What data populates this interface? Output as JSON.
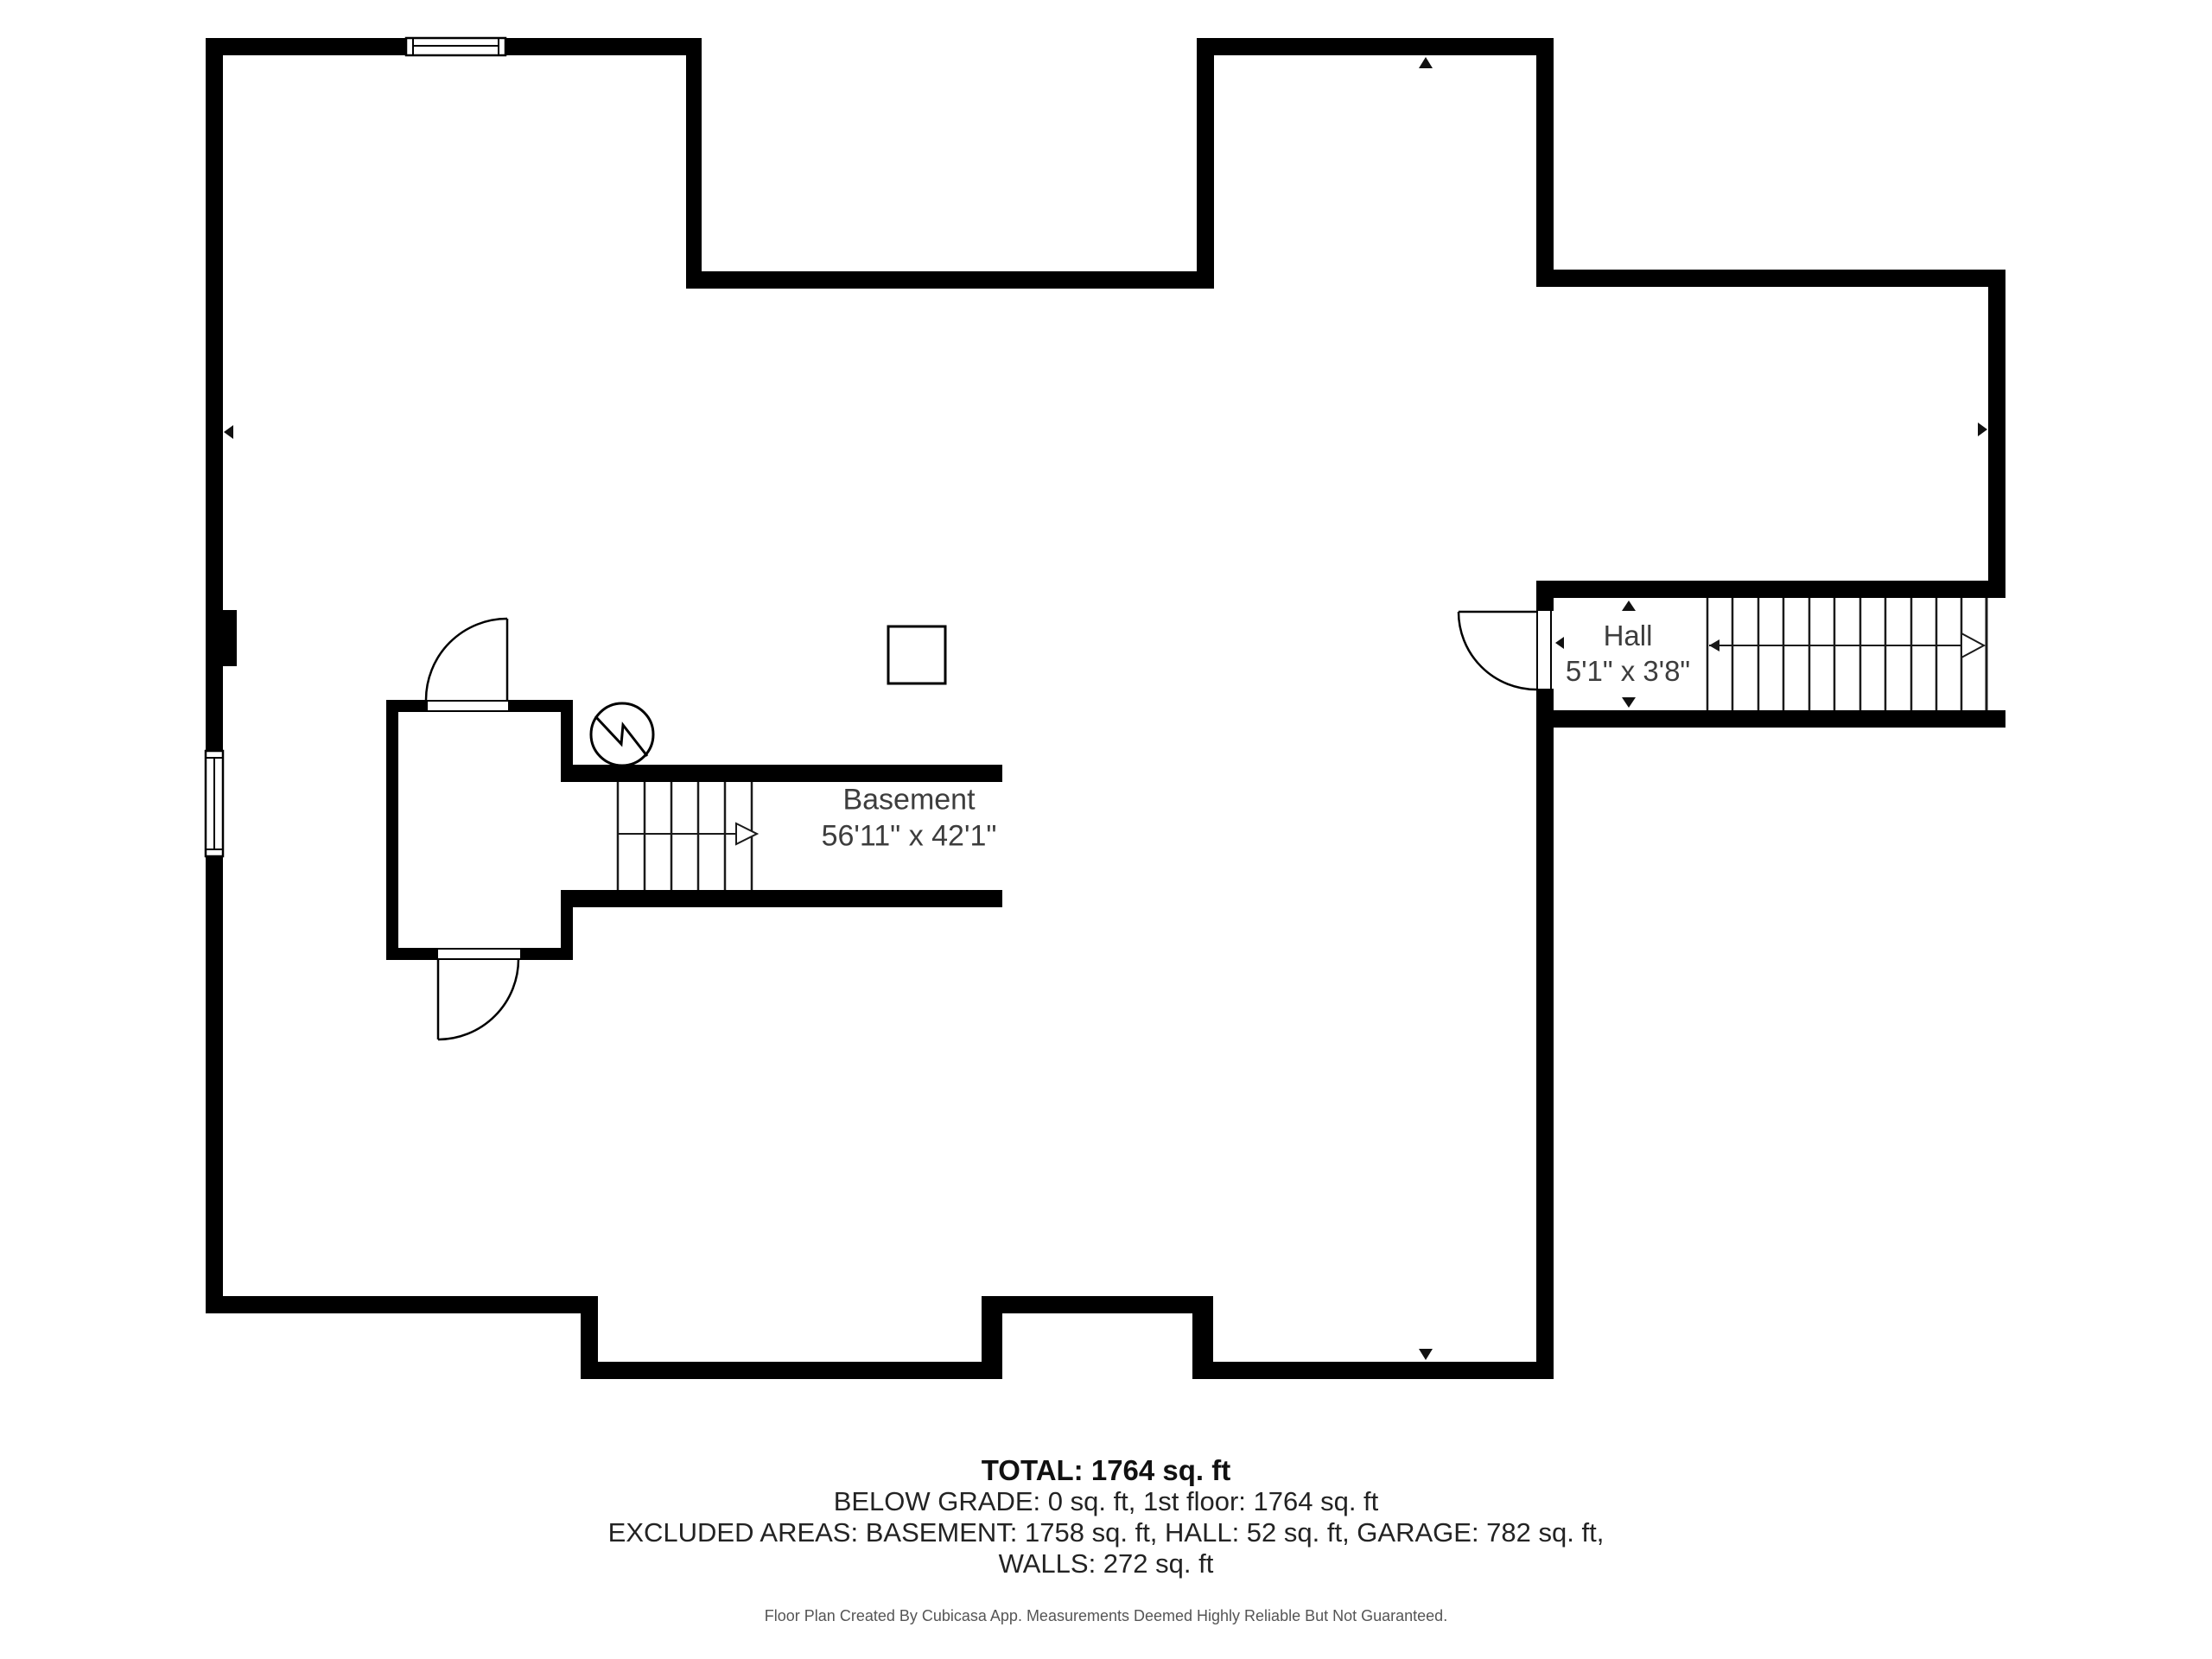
{
  "rooms": {
    "basement": {
      "name": "Basement",
      "dimensions": "56'11\" x 42'1\""
    },
    "hall": {
      "name": "Hall",
      "dimensions": "5'1\" x 3'8\""
    }
  },
  "summary": {
    "total": "TOTAL: 1764 sq. ft",
    "below_grade": "BELOW GRADE: 0 sq. ft, 1st floor: 1764 sq. ft",
    "excluded_areas": "EXCLUDED AREAS: BASEMENT: 1758 sq. ft, HALL: 52 sq. ft, GARAGE: 782 sq. ft,",
    "walls": "WALLS: 272 sq. ft"
  },
  "footer": {
    "disclaimer": "Floor Plan Created By Cubicasa App. Measurements Deemed Highly Reliable But Not Guaranteed."
  },
  "colors": {
    "wall": "#000000",
    "background": "#ffffff",
    "room_label": "#3d3d3d",
    "summary_text": "#232323",
    "footer_text": "#555555"
  },
  "icons": {
    "furnace": "furnace-circle-bolt-icon",
    "window": "window-icon",
    "door": "door-swing-icon",
    "stairs": "stair-treads-icon",
    "direction_arrow": "stair-direction-arrow-icon",
    "dimension_marker": "dimension-triangle-icon",
    "post": "column-post-icon",
    "chimney": "chimney-stub-icon"
  }
}
